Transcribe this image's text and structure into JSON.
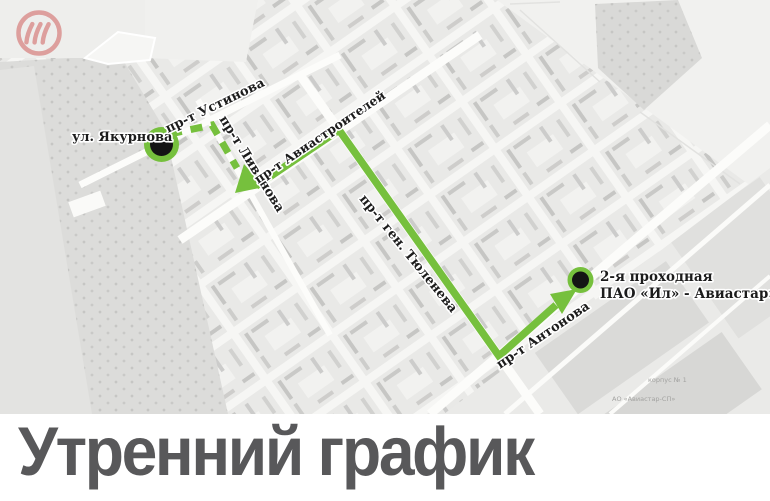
{
  "brand": {
    "logo": "il-aviastar-circle-logo",
    "logo_color": "#dd9f9d"
  },
  "title": {
    "text": "Утренний график",
    "color": "#58585a"
  },
  "route": {
    "color": "#76c03d",
    "marker_color": "#141414",
    "start_stop": "ул. Якурнова",
    "end_stop_line1": "2-я проходная",
    "end_stop_line2": "ПАО «Ил» - Авиастар»"
  },
  "map": {
    "street_labels": [
      {
        "text": "ул. Якурнова"
      },
      {
        "text": "пр-т Устинова"
      },
      {
        "text": "пр-т Ливанова"
      },
      {
        "text": "пр-т Авиастроителей"
      },
      {
        "text": "пр-т ген. Тюленева"
      },
      {
        "text": "пр-т Антонова"
      }
    ],
    "area_labels": [
      {
        "text": "корпус № 1"
      },
      {
        "text": "АО «Авиастар-СП»"
      }
    ]
  }
}
